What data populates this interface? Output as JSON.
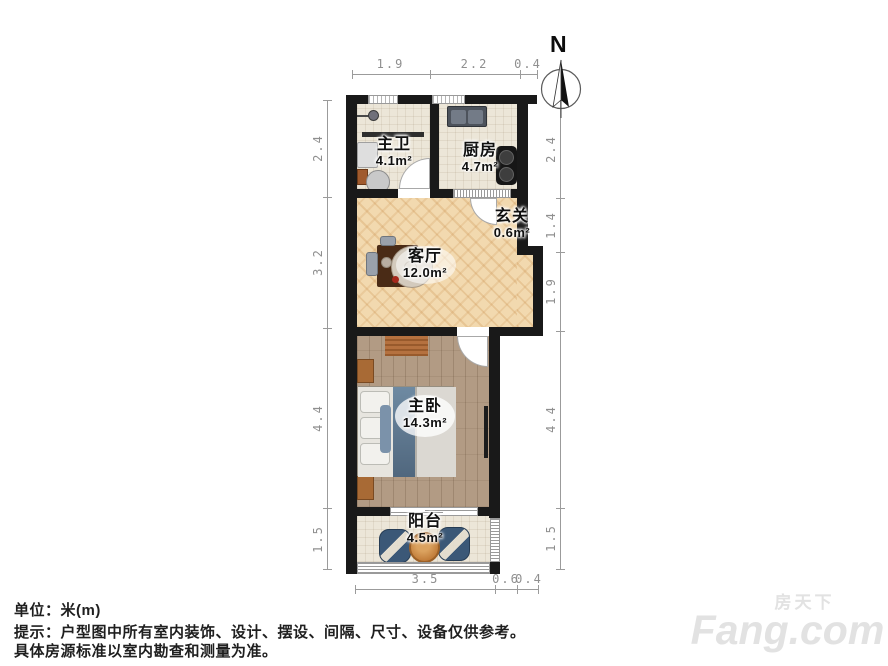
{
  "plan": {
    "rooms": [
      {
        "name": "主卫",
        "area": "4.1m²"
      },
      {
        "name": "厨房",
        "area": "4.7m²"
      },
      {
        "name": "玄关",
        "area": "0.6m²"
      },
      {
        "name": "客厅",
        "area": "12.0m²"
      },
      {
        "name": "主卧",
        "area": "14.3m²"
      },
      {
        "name": "阳台",
        "area": "4.5m²"
      }
    ],
    "compass_label": "N",
    "dimensions": {
      "top": [
        "1.9",
        "2.2",
        "0.4"
      ],
      "left": [
        "2.4",
        "3.2",
        "4.4",
        "1.5"
      ],
      "right": [
        "2.4",
        "1.4",
        "1.9",
        "4.4",
        "1.5"
      ],
      "bottom": [
        "3.5",
        "0.6",
        "0.4"
      ]
    }
  },
  "footer": {
    "unit": "单位：米(m)",
    "tip_line1": "提示：户型图中所有室内装饰、设计、摆设、间隔、尺寸、设备仅供参考。",
    "tip_line2": "具体房源标准以室内勘查和测量为准。"
  },
  "watermark": {
    "cn": "房天下",
    "en": "Fang.com"
  },
  "colors": {
    "wall": "#191919",
    "dim_line": "#9b9b9b",
    "herringbone_wood": "#f2d9af",
    "plank_wood": "#b29b84",
    "tile": "#ece6d8",
    "bed_blue": "#5f7a92"
  }
}
